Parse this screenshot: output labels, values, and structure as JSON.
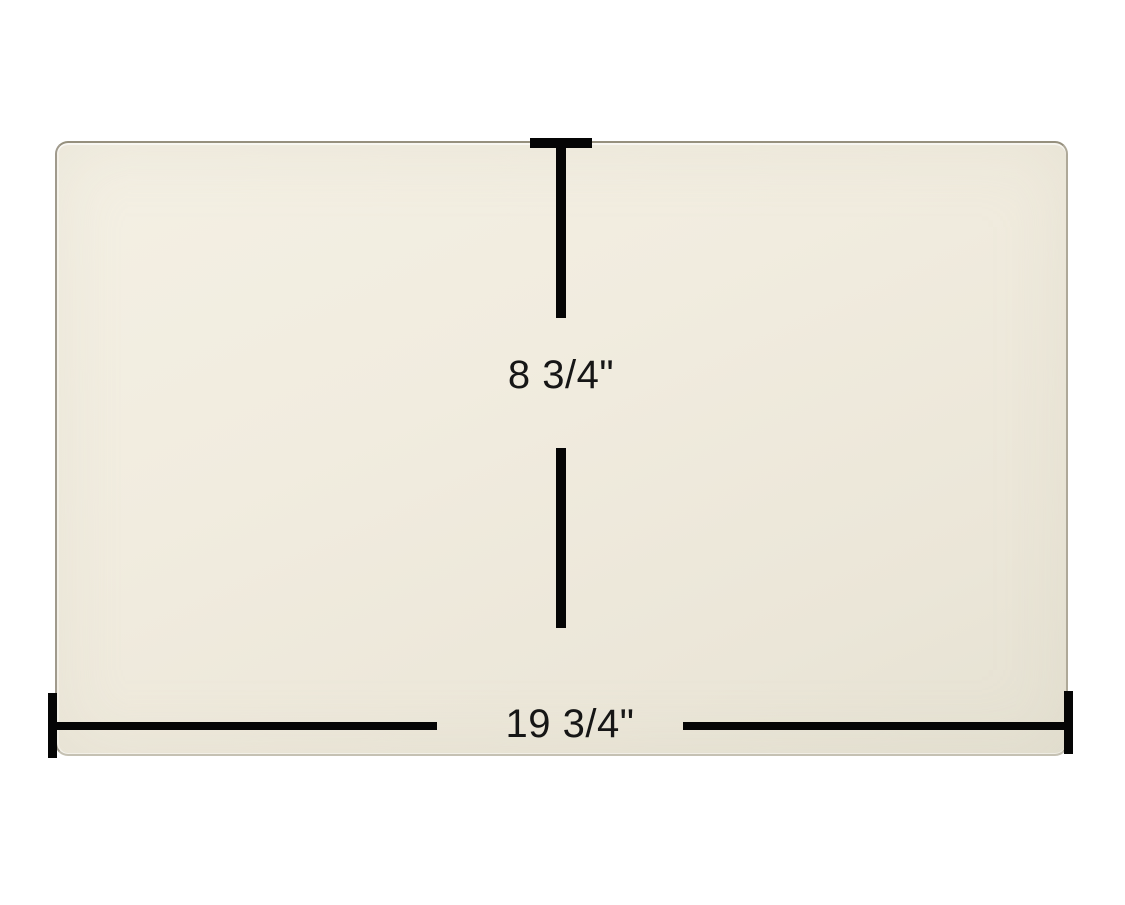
{
  "diagram": {
    "height_dimension": {
      "label": "8 3/4\""
    },
    "width_dimension": {
      "label": "19 3/4\""
    },
    "colors": {
      "background": "#ffffff",
      "glass_fill": "#f0ebde",
      "glass_edge": "#9d978a",
      "dimension_line": "#050505",
      "label_text": "#161616"
    }
  }
}
